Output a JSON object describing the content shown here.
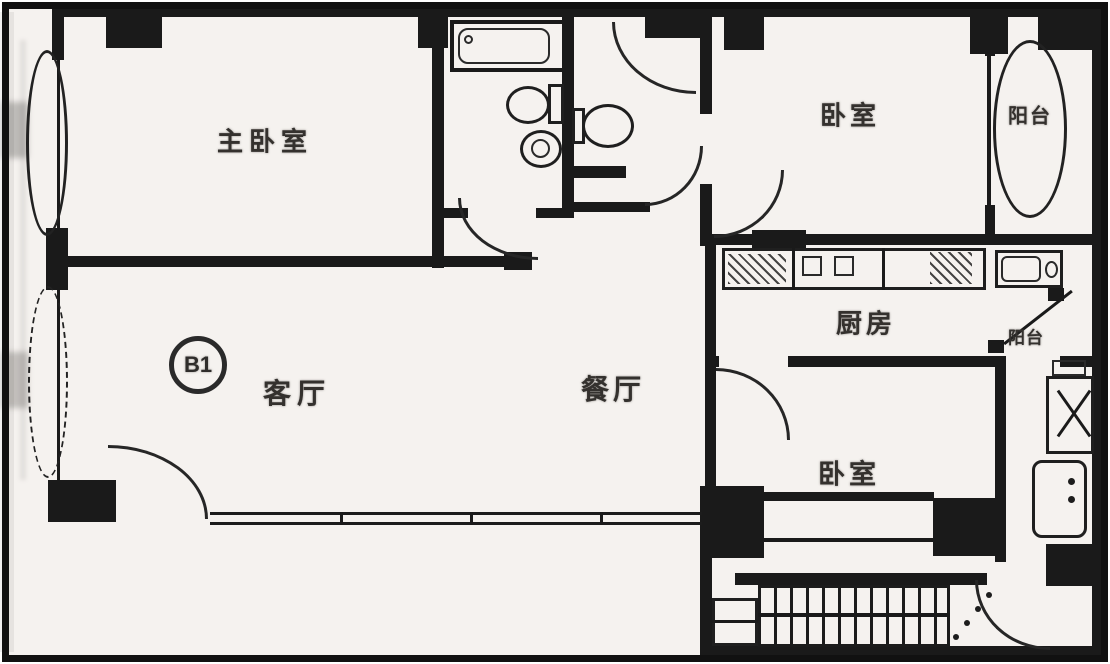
{
  "plan": {
    "unit_badge": "B1",
    "rooms": {
      "master_bedroom": "主卧室",
      "bedroom_top_right": "卧室",
      "bedroom_bottom_right": "卧室",
      "living_room": "客厅",
      "dining_room": "餐厅",
      "kitchen": "厨房",
      "balcony_right": "阳台",
      "balcony_service": "阳台"
    },
    "colors": {
      "wall": "#1a1a1a",
      "paper": "#f5f2ef",
      "ink": "#34312e"
    }
  }
}
